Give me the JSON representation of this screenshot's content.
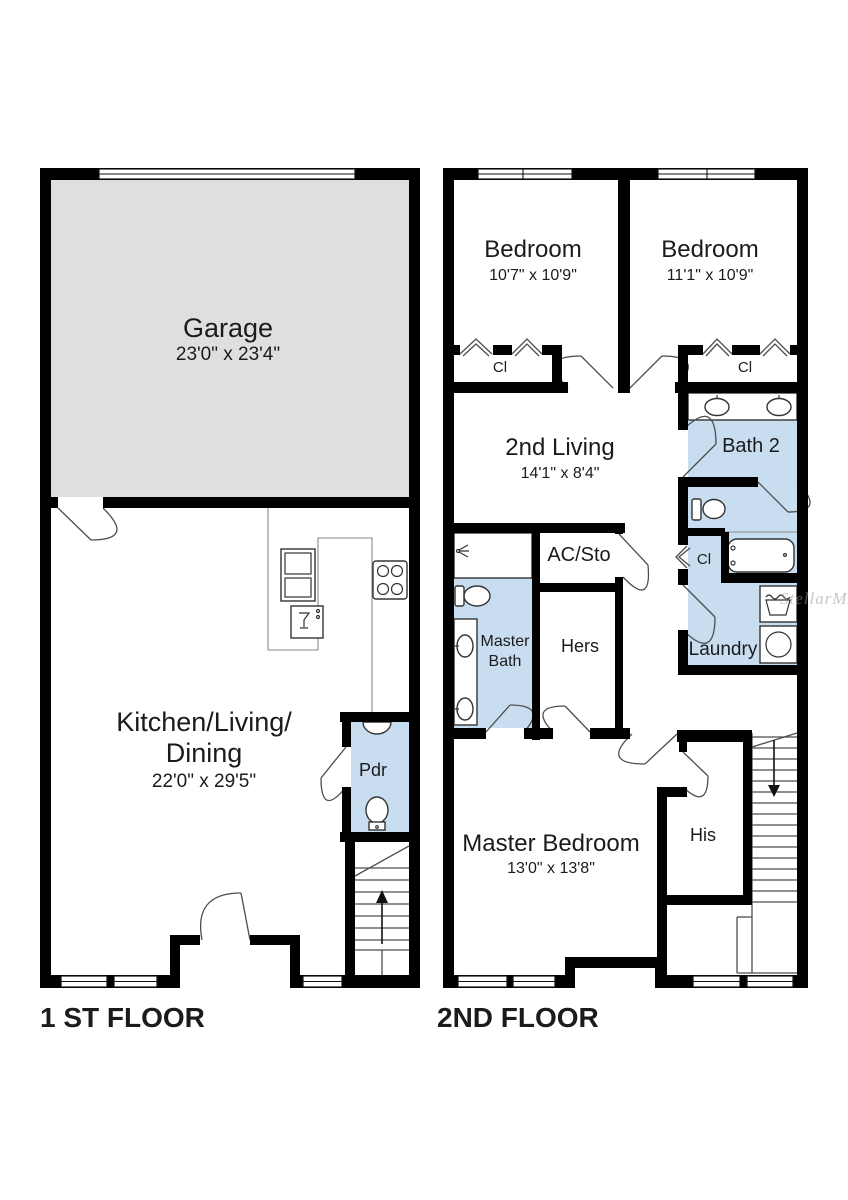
{
  "floors": [
    {
      "label": "1 ST FLOOR",
      "rooms": {
        "garage": {
          "name": "Garage",
          "dims": "23'0\" x 23'4\""
        },
        "kitchen_living_dining": {
          "line1": "Kitchen/Living/",
          "line2": "Dining",
          "dims": "22'0\" x 29'5\""
        },
        "powder": {
          "name": "Pdr"
        }
      }
    },
    {
      "label": "2ND FLOOR",
      "rooms": {
        "bedroom_left": {
          "name": "Bedroom",
          "dims": "10'7\" x 10'9\""
        },
        "bedroom_right": {
          "name": "Bedroom",
          "dims": "11'1\" x 10'9\""
        },
        "closet_left": {
          "name": "Cl"
        },
        "closet_right": {
          "name": "Cl"
        },
        "second_living": {
          "name": "2nd Living",
          "dims": "14'1\" x 8'4\""
        },
        "bath2": {
          "name": "Bath 2"
        },
        "ac_storage": {
          "name": "AC/Sto"
        },
        "master_bath": {
          "line1": "Master",
          "line2": "Bath"
        },
        "hers_closet": {
          "name": "Hers"
        },
        "closet_hall": {
          "name": "Cl"
        },
        "laundry": {
          "name": "Laundry"
        },
        "master_bedroom": {
          "name": "Master Bedroom",
          "dims": "13'0\" x 13'8\""
        },
        "his_closet": {
          "name": "His"
        }
      }
    }
  ],
  "watermark": "StellarMLS",
  "colors": {
    "wall": "#000000",
    "room-blue": "#c9ddf0",
    "garage-gray": "#dfdfdf",
    "fixture-line": "#4d4d4d",
    "text": "#1b1b1b"
  }
}
